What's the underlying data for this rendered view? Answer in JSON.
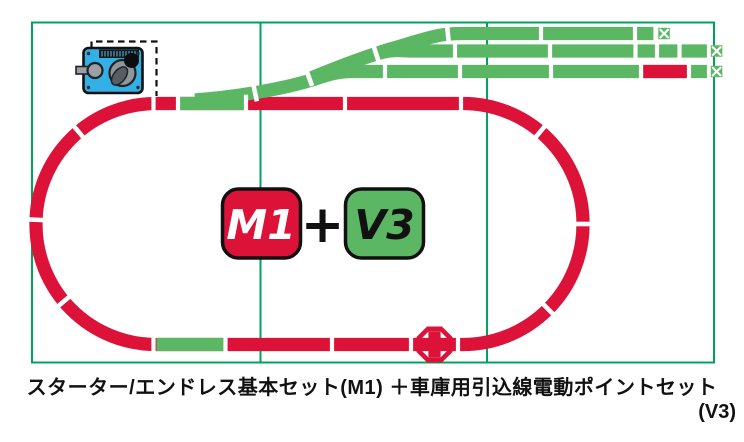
{
  "caption": {
    "line1": "スターター/エンドレス基本セット(M1) ＋車庫用引込線電動ポイントセット",
    "line2": "(V3)"
  },
  "badges": {
    "m1": "M1",
    "plus": "+",
    "v3": "V3"
  },
  "colors": {
    "track_red": "#dc1238",
    "track_green": "#5bb763",
    "base_green": "#00a35b",
    "pack_blue": "#33b0e6",
    "ink_black": "#111111"
  },
  "icons": {
    "power_pack": "power-pack-controller-icon",
    "feeder_cable": "feeder-cable-dashed-line",
    "rerailer": "rerailer-crossing-icon",
    "bumper": "track-end-bumper-icon"
  }
}
